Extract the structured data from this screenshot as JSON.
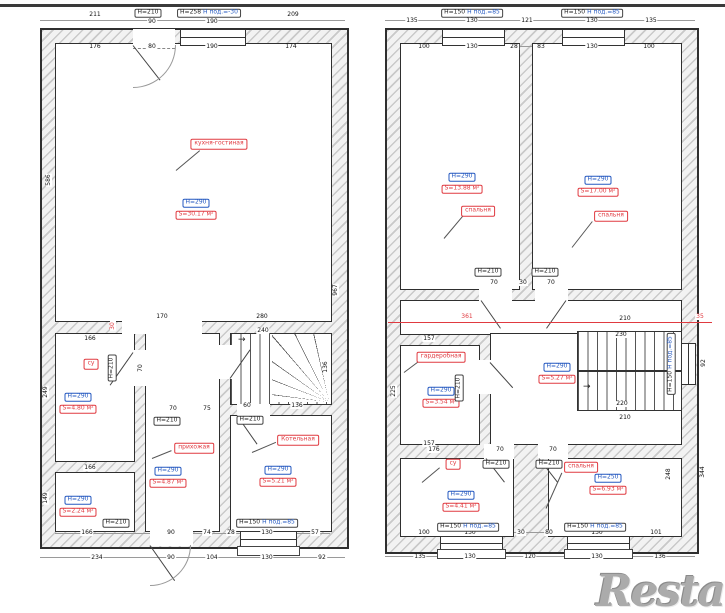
{
  "watermark": "Restate",
  "colors": {
    "accent_red": "#e03a40",
    "accent_blue": "#2559c0",
    "wall_line": "#2f2f2f",
    "hatch": "#c9c9c9"
  },
  "floor1": {
    "kitchen": {
      "name": "кухня-гостиная",
      "height": "H=290",
      "area": "S=30.17 м²"
    },
    "wc": {
      "name": "су",
      "height": "H=290",
      "area": "S=4.80 м²"
    },
    "storage": {
      "height": "H=290",
      "area": "S=2.24 м²"
    },
    "hallway": {
      "name": "прихожая",
      "height": "H=290",
      "area": "S=4.87 м²"
    },
    "boiler": {
      "name": "Котельная",
      "height": "H=290",
      "area": "S=5.21 м²"
    },
    "door_label": "H=210",
    "top_window_label": "H=258",
    "top_window_sub": "H под.=-30",
    "window_label": "H=150",
    "window_sub": "H под.=85"
  },
  "floor2": {
    "bedroom_left": {
      "name": "спальня",
      "height": "H=290",
      "area": "S=13.88 м²"
    },
    "bedroom_right": {
      "name": "спальня",
      "height": "H=290",
      "area": "S=17.00 м²"
    },
    "wardrobe": {
      "name": "гардеробная",
      "height": "H=290",
      "area": "S=3.54 м²"
    },
    "hall": {
      "height": "H=290",
      "area": "S=5.27 м²"
    },
    "wc": {
      "name": "су",
      "height": "H=290",
      "area": "S=4.41 м²"
    },
    "bedroom_small": {
      "name": "спальня",
      "height": "H=250",
      "area": "S=6.93 м²"
    },
    "door_label": "H=210",
    "window_label": "H=150",
    "window_sub": "H под.=85"
  },
  "dimensions": [
    {
      "t": "211",
      "x": 95,
      "y": 15
    },
    {
      "t": "209",
      "x": 293,
      "y": 15
    },
    {
      "t": "90",
      "x": 152,
      "y": 22
    },
    {
      "t": "190",
      "x": 212,
      "y": 22
    },
    {
      "t": "176",
      "x": 95,
      "y": 47
    },
    {
      "t": "80",
      "x": 152,
      "y": 47
    },
    {
      "t": "190",
      "x": 212,
      "y": 47
    },
    {
      "t": "174",
      "x": 291,
      "y": 47
    },
    {
      "t": "586",
      "x": 49,
      "y": 180,
      "r": 1
    },
    {
      "t": "967",
      "x": 336,
      "y": 290,
      "r": 1
    },
    {
      "t": "170",
      "x": 162,
      "y": 317
    },
    {
      "t": "280",
      "x": 262,
      "y": 317
    },
    {
      "t": "30",
      "x": 113,
      "y": 326,
      "r": 1,
      "c": "red"
    },
    {
      "t": "240",
      "x": 263,
      "y": 331
    },
    {
      "t": "136",
      "x": 326,
      "y": 367,
      "r": 1
    },
    {
      "t": "60",
      "x": 247,
      "y": 406
    },
    {
      "t": "136",
      "x": 297,
      "y": 406
    },
    {
      "t": "166",
      "x": 90,
      "y": 339
    },
    {
      "t": "249",
      "x": 46,
      "y": 392,
      "r": 1
    },
    {
      "t": "70",
      "x": 141,
      "y": 368,
      "r": 1
    },
    {
      "t": "70",
      "x": 173,
      "y": 409
    },
    {
      "t": "75",
      "x": 207,
      "y": 409
    },
    {
      "t": "166",
      "x": 90,
      "y": 468
    },
    {
      "t": "149",
      "x": 46,
      "y": 498,
      "r": 1
    },
    {
      "t": "166",
      "x": 87,
      "y": 533
    },
    {
      "t": "90",
      "x": 171,
      "y": 533
    },
    {
      "t": "74",
      "x": 207,
      "y": 533
    },
    {
      "t": "28",
      "x": 231,
      "y": 533
    },
    {
      "t": "130",
      "x": 267,
      "y": 533
    },
    {
      "t": "57",
      "x": 315,
      "y": 533
    },
    {
      "t": "234",
      "x": 97,
      "y": 558
    },
    {
      "t": "90",
      "x": 171,
      "y": 558
    },
    {
      "t": "104",
      "x": 212,
      "y": 558
    },
    {
      "t": "130",
      "x": 267,
      "y": 558
    },
    {
      "t": "92",
      "x": 322,
      "y": 558
    },
    {
      "t": "135",
      "x": 412,
      "y": 21
    },
    {
      "t": "130",
      "x": 472,
      "y": 21
    },
    {
      "t": "121",
      "x": 527,
      "y": 21
    },
    {
      "t": "130",
      "x": 592,
      "y": 21
    },
    {
      "t": "135",
      "x": 651,
      "y": 21
    },
    {
      "t": "100",
      "x": 424,
      "y": 47
    },
    {
      "t": "130",
      "x": 472,
      "y": 47
    },
    {
      "t": "28",
      "x": 514,
      "y": 47
    },
    {
      "t": "83",
      "x": 541,
      "y": 47
    },
    {
      "t": "130",
      "x": 592,
      "y": 47
    },
    {
      "t": "100",
      "x": 649,
      "y": 47
    },
    {
      "t": "70",
      "x": 494,
      "y": 283
    },
    {
      "t": "30",
      "x": 523,
      "y": 283
    },
    {
      "t": "70",
      "x": 551,
      "y": 283
    },
    {
      "t": "361",
      "x": 467,
      "y": 317,
      "c": "red"
    },
    {
      "t": "35",
      "x": 700,
      "y": 317,
      "c": "red"
    },
    {
      "t": "157",
      "x": 429,
      "y": 339
    },
    {
      "t": "225",
      "x": 394,
      "y": 391,
      "r": 1
    },
    {
      "t": "157",
      "x": 429,
      "y": 444
    },
    {
      "t": "210",
      "x": 625,
      "y": 319
    },
    {
      "t": "230",
      "x": 621,
      "y": 335
    },
    {
      "t": "220",
      "x": 622,
      "y": 404
    },
    {
      "t": "210",
      "x": 625,
      "y": 418
    },
    {
      "t": "92",
      "x": 704,
      "y": 363,
      "r": 1
    },
    {
      "t": "176",
      "x": 434,
      "y": 450
    },
    {
      "t": "70",
      "x": 500,
      "y": 450
    },
    {
      "t": "70",
      "x": 553,
      "y": 450
    },
    {
      "t": "248",
      "x": 669,
      "y": 474,
      "r": 1
    },
    {
      "t": "344",
      "x": 703,
      "y": 472,
      "r": 1
    },
    {
      "t": "100",
      "x": 424,
      "y": 533
    },
    {
      "t": "130",
      "x": 470,
      "y": 533
    },
    {
      "t": "30",
      "x": 521,
      "y": 533
    },
    {
      "t": "80",
      "x": 549,
      "y": 533
    },
    {
      "t": "130",
      "x": 597,
      "y": 533
    },
    {
      "t": "101",
      "x": 656,
      "y": 533
    },
    {
      "t": "135",
      "x": 420,
      "y": 557
    },
    {
      "t": "130",
      "x": 470,
      "y": 557
    },
    {
      "t": "120",
      "x": 530,
      "y": 557
    },
    {
      "t": "130",
      "x": 597,
      "y": 557
    },
    {
      "t": "136",
      "x": 660,
      "y": 557
    }
  ]
}
